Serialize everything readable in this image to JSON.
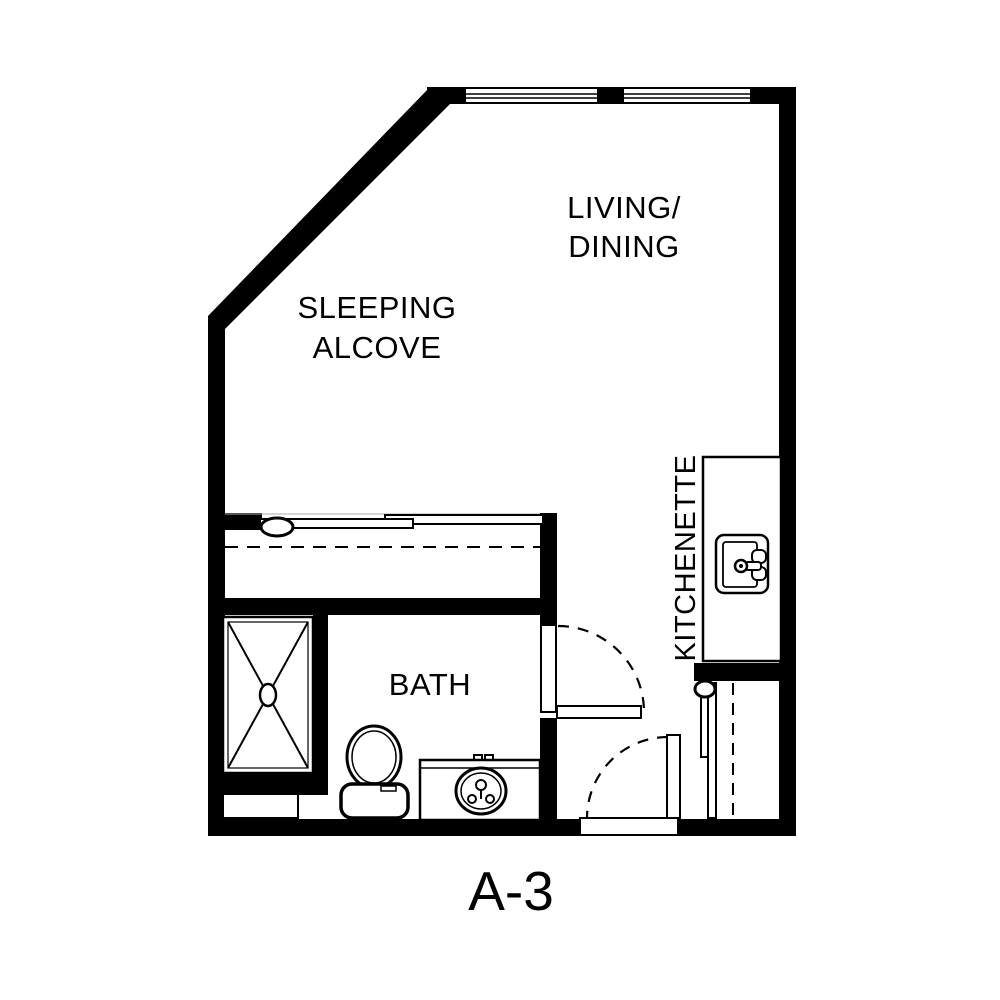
{
  "plan_title": "A-3",
  "rooms": {
    "living_dining": {
      "line1": "LIVING/",
      "line2": "DINING"
    },
    "sleeping_alcove": {
      "line1": "SLEEPING",
      "line2": "ALCOVE"
    },
    "kitchenette": {
      "label": "KITCHENETTE"
    },
    "bath": {
      "label": "BATH"
    }
  },
  "fixtures": [
    "window",
    "window",
    "closet-bypass-sliding-doors",
    "closet-shelf-dashed-line",
    "shower-stall",
    "shower-drain",
    "shower-niche",
    "toilet",
    "vanity-sink",
    "kitchen-sink",
    "bath-swing-door",
    "entry-swing-door",
    "wardrobe-sliding-door",
    "wardrobe-shelf-dashed-line"
  ],
  "colors": {
    "wall": "#000000",
    "line": "#000000",
    "background": "#ffffff"
  }
}
